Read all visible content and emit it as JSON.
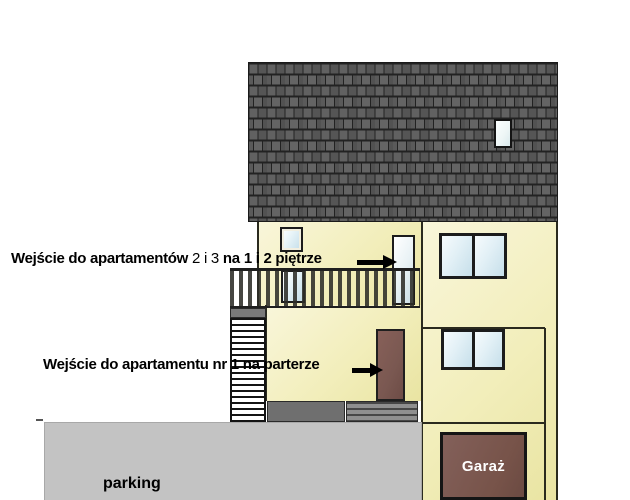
{
  "scene": "building-front-elevation-drawing",
  "annotations": {
    "upper_part1": "Wejście do apartamentów",
    "upper_part2": "2 i 3",
    "upper_part3": "na",
    "upper_part4": "1 i 2 piętrze",
    "ground": "Wejście do apartamentu nr 1 na parterze"
  },
  "labels": {
    "parking": "parking",
    "garage": "Garaż"
  },
  "icons": {
    "upper_annotation_arrow": "right-arrow",
    "ground_annotation_arrow": "right-arrow"
  },
  "colors": {
    "wall_cream": "#f2eebb",
    "roof_gray": "#565656",
    "roof_joints": "#222222",
    "window_frame": "#1c1c1c",
    "window_glass": "#d9ecf3",
    "entrance_door_brown": "#7a5851",
    "garage_door_brown": "#775349",
    "parking_gray": "#c3c3c3",
    "platform_gray": "#6f6f6f",
    "stairs_white": "#ffffff",
    "annotation_text": "#000000",
    "garage_label_text": "#ffffff"
  }
}
